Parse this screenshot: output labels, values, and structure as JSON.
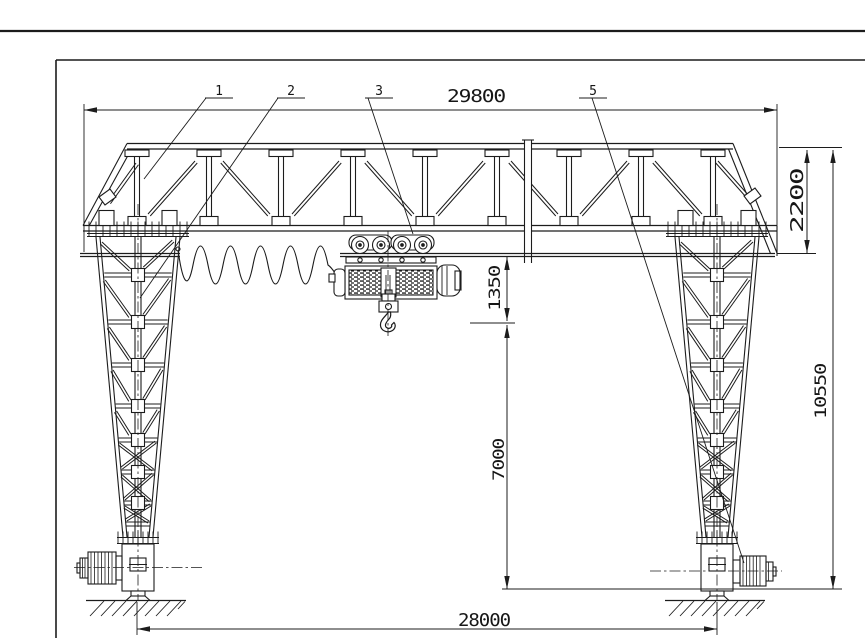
{
  "sheet": {
    "background_color": "#ffffff",
    "line_color": "#1c1c1c",
    "drawing_type": "gantry-crane-general-arrangement"
  },
  "callouts": {
    "c1": {
      "label": "1"
    },
    "c2": {
      "label": "2"
    },
    "c3": {
      "label": "3"
    },
    "c5": {
      "label": "5"
    }
  },
  "dimensions": {
    "girder_overall_length": {
      "value": "29800"
    },
    "girder_depth": {
      "value": "2200"
    },
    "hoist_headroom": {
      "value": "1350"
    },
    "clear_height_under_girder": {
      "value": "7000"
    },
    "overall_height": {
      "value": "10550"
    },
    "rail_span": {
      "value": "28000"
    }
  }
}
